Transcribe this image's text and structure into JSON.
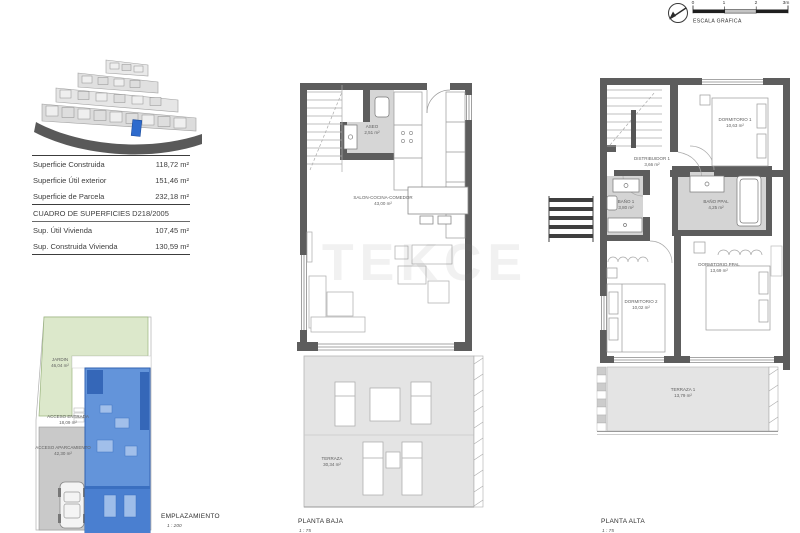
{
  "scale_graphic": {
    "label": "ESCALA GRÁFICA",
    "ticks": [
      "0",
      "1",
      "2",
      "3m"
    ]
  },
  "summary_table": {
    "rows": [
      {
        "label": "Superficie Construida",
        "value": "118,72 m²"
      },
      {
        "label": "Superficie Útil exterior",
        "value": "151,46 m²"
      },
      {
        "label": "Superficie de Parcela",
        "value": "232,18 m²"
      }
    ],
    "section_title": "CUADRO DE SUPERFICIES D218/2005",
    "section_rows": [
      {
        "label": "Sup. Útil Vivienda",
        "value": "107,45 m²"
      },
      {
        "label": "Sup. Construida Vivienda",
        "value": "130,59 m²"
      }
    ]
  },
  "site_plan": {
    "title": "EMPLAZAMIENTO",
    "scale": "1 : 200",
    "jardin": {
      "name": "JARDIN",
      "area": "46,04 m²"
    },
    "acceso_entrada": {
      "name": "ACCESO ENTRADA",
      "area": "18,09 m²"
    },
    "acceso_aparcamiento": {
      "name": "ACCESO APARCAMIENTO",
      "area": "42,30 m²"
    }
  },
  "planta_baja": {
    "title": "PLANTA BAJA",
    "scale": "1 : 75",
    "aseo": {
      "name": "ASEO",
      "area": "2,51 m²"
    },
    "salon": {
      "name": "SALON-COCINA-COMEDOR",
      "area": "43,00 m²"
    },
    "terraza": {
      "name": "TERRAZA",
      "area": "30,34 m²"
    }
  },
  "planta_alta": {
    "title": "PLANTA ALTA",
    "scale": "1 : 75",
    "dormitorio_1": {
      "name": "DORMITORIO 1",
      "area": "10,63 m²"
    },
    "distribuidor_1": {
      "name": "DISTRIBUIDOR 1",
      "area": "3,66 m²"
    },
    "bano_1": {
      "name": "BAÑO 1",
      "area": "3,80 m²"
    },
    "bano_ppal": {
      "name": "BAÑO PPAL",
      "area": "4,25 m²"
    },
    "dormitorio_2": {
      "name": "DORMITORIO 2",
      "area": "10,02 m²"
    },
    "dormitorio_ppal": {
      "name": "DORMITORIO PPAL",
      "area": "13,69 m²"
    },
    "terraza_1": {
      "name": "TERRAZA 1",
      "area": "13,79 m²"
    }
  },
  "watermark": "TEKCE",
  "colors": {
    "unit_highlight_blue": "#2e6bcd",
    "garden_green": "#dce8cb",
    "wall_gray": "#5d5d5d"
  }
}
